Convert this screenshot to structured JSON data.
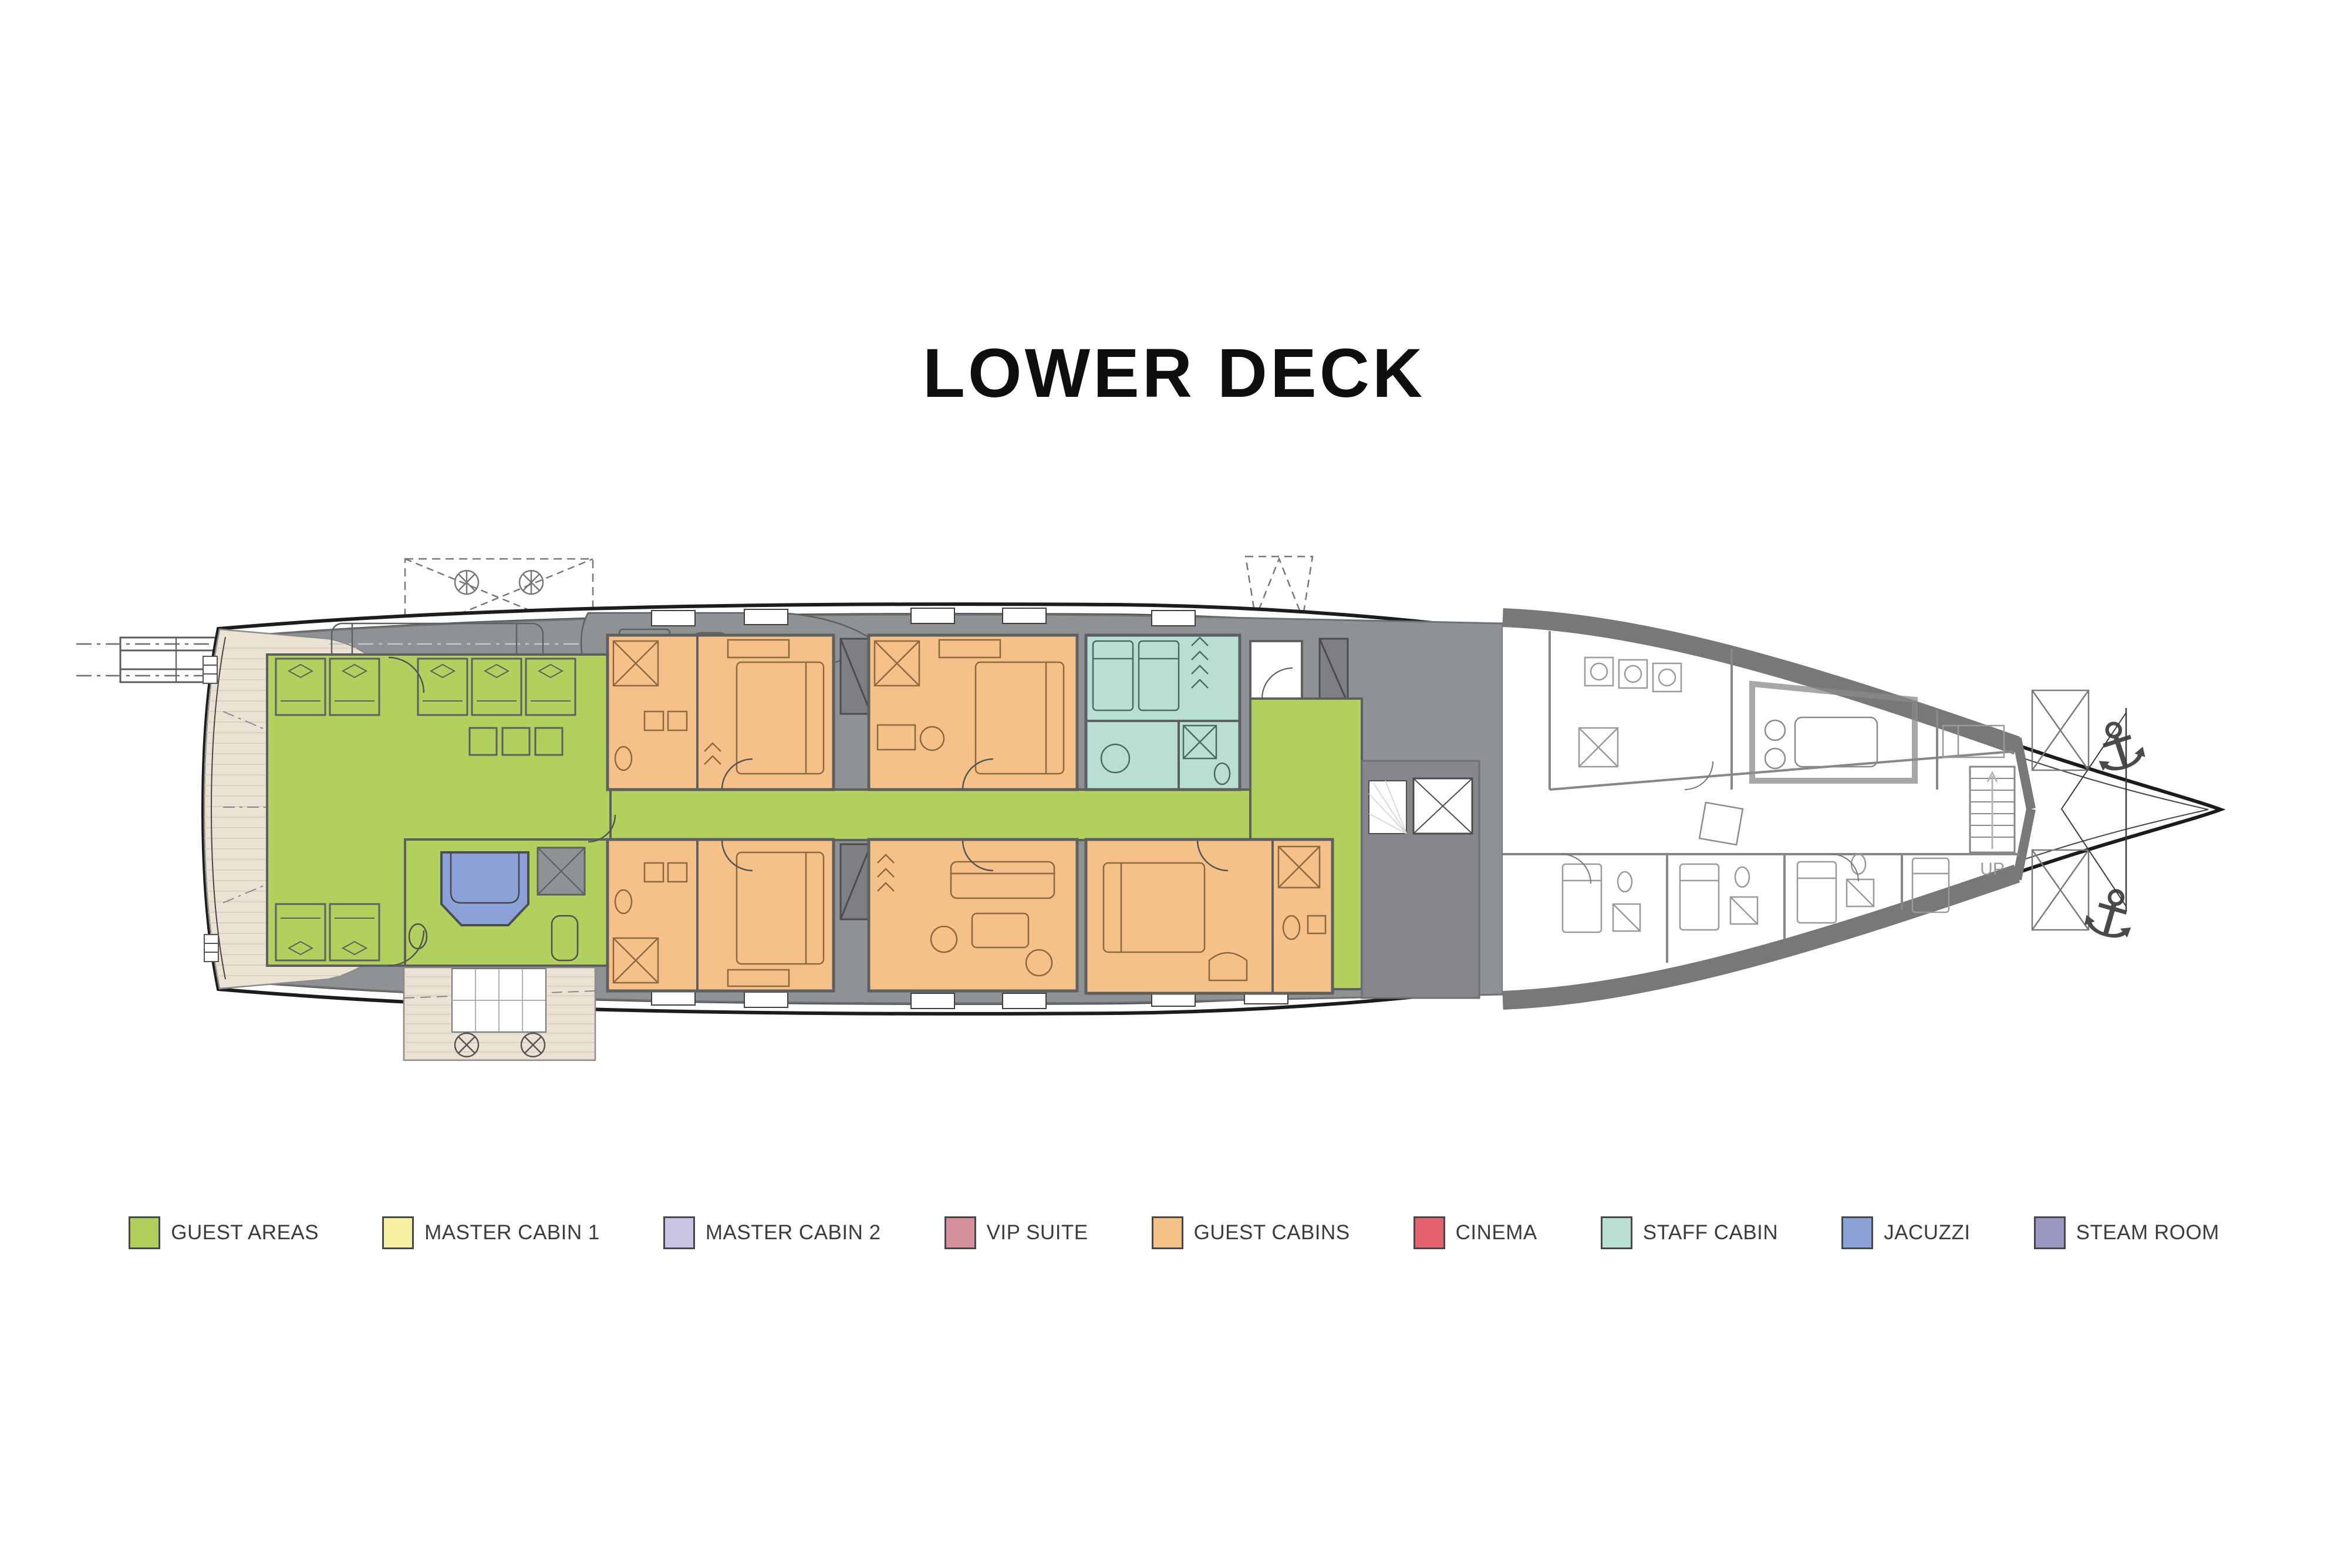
{
  "title": "LOWER DECK",
  "plan": {
    "up_label": "UP",
    "anchor_icon": "⚓"
  },
  "legend": {
    "items": [
      {
        "label": "GUEST AREAS",
        "color": "#b2d05e"
      },
      {
        "label": "MASTER CABIN 1",
        "color": "#f5f1a0"
      },
      {
        "label": "MASTER CABIN 2",
        "color": "#cbc4e4"
      },
      {
        "label": "VIP SUITE",
        "color": "#d5919e"
      },
      {
        "label": "GUEST CABINS",
        "color": "#f6c188"
      },
      {
        "label": "CINEMA",
        "color": "#e4616f"
      },
      {
        "label": "STAFF CABIN",
        "color": "#b9dfd2"
      },
      {
        "label": "JACUZZI",
        "color": "#8ba2d8"
      },
      {
        "label": "STEAM ROOM",
        "color": "#9a98c3"
      }
    ]
  }
}
